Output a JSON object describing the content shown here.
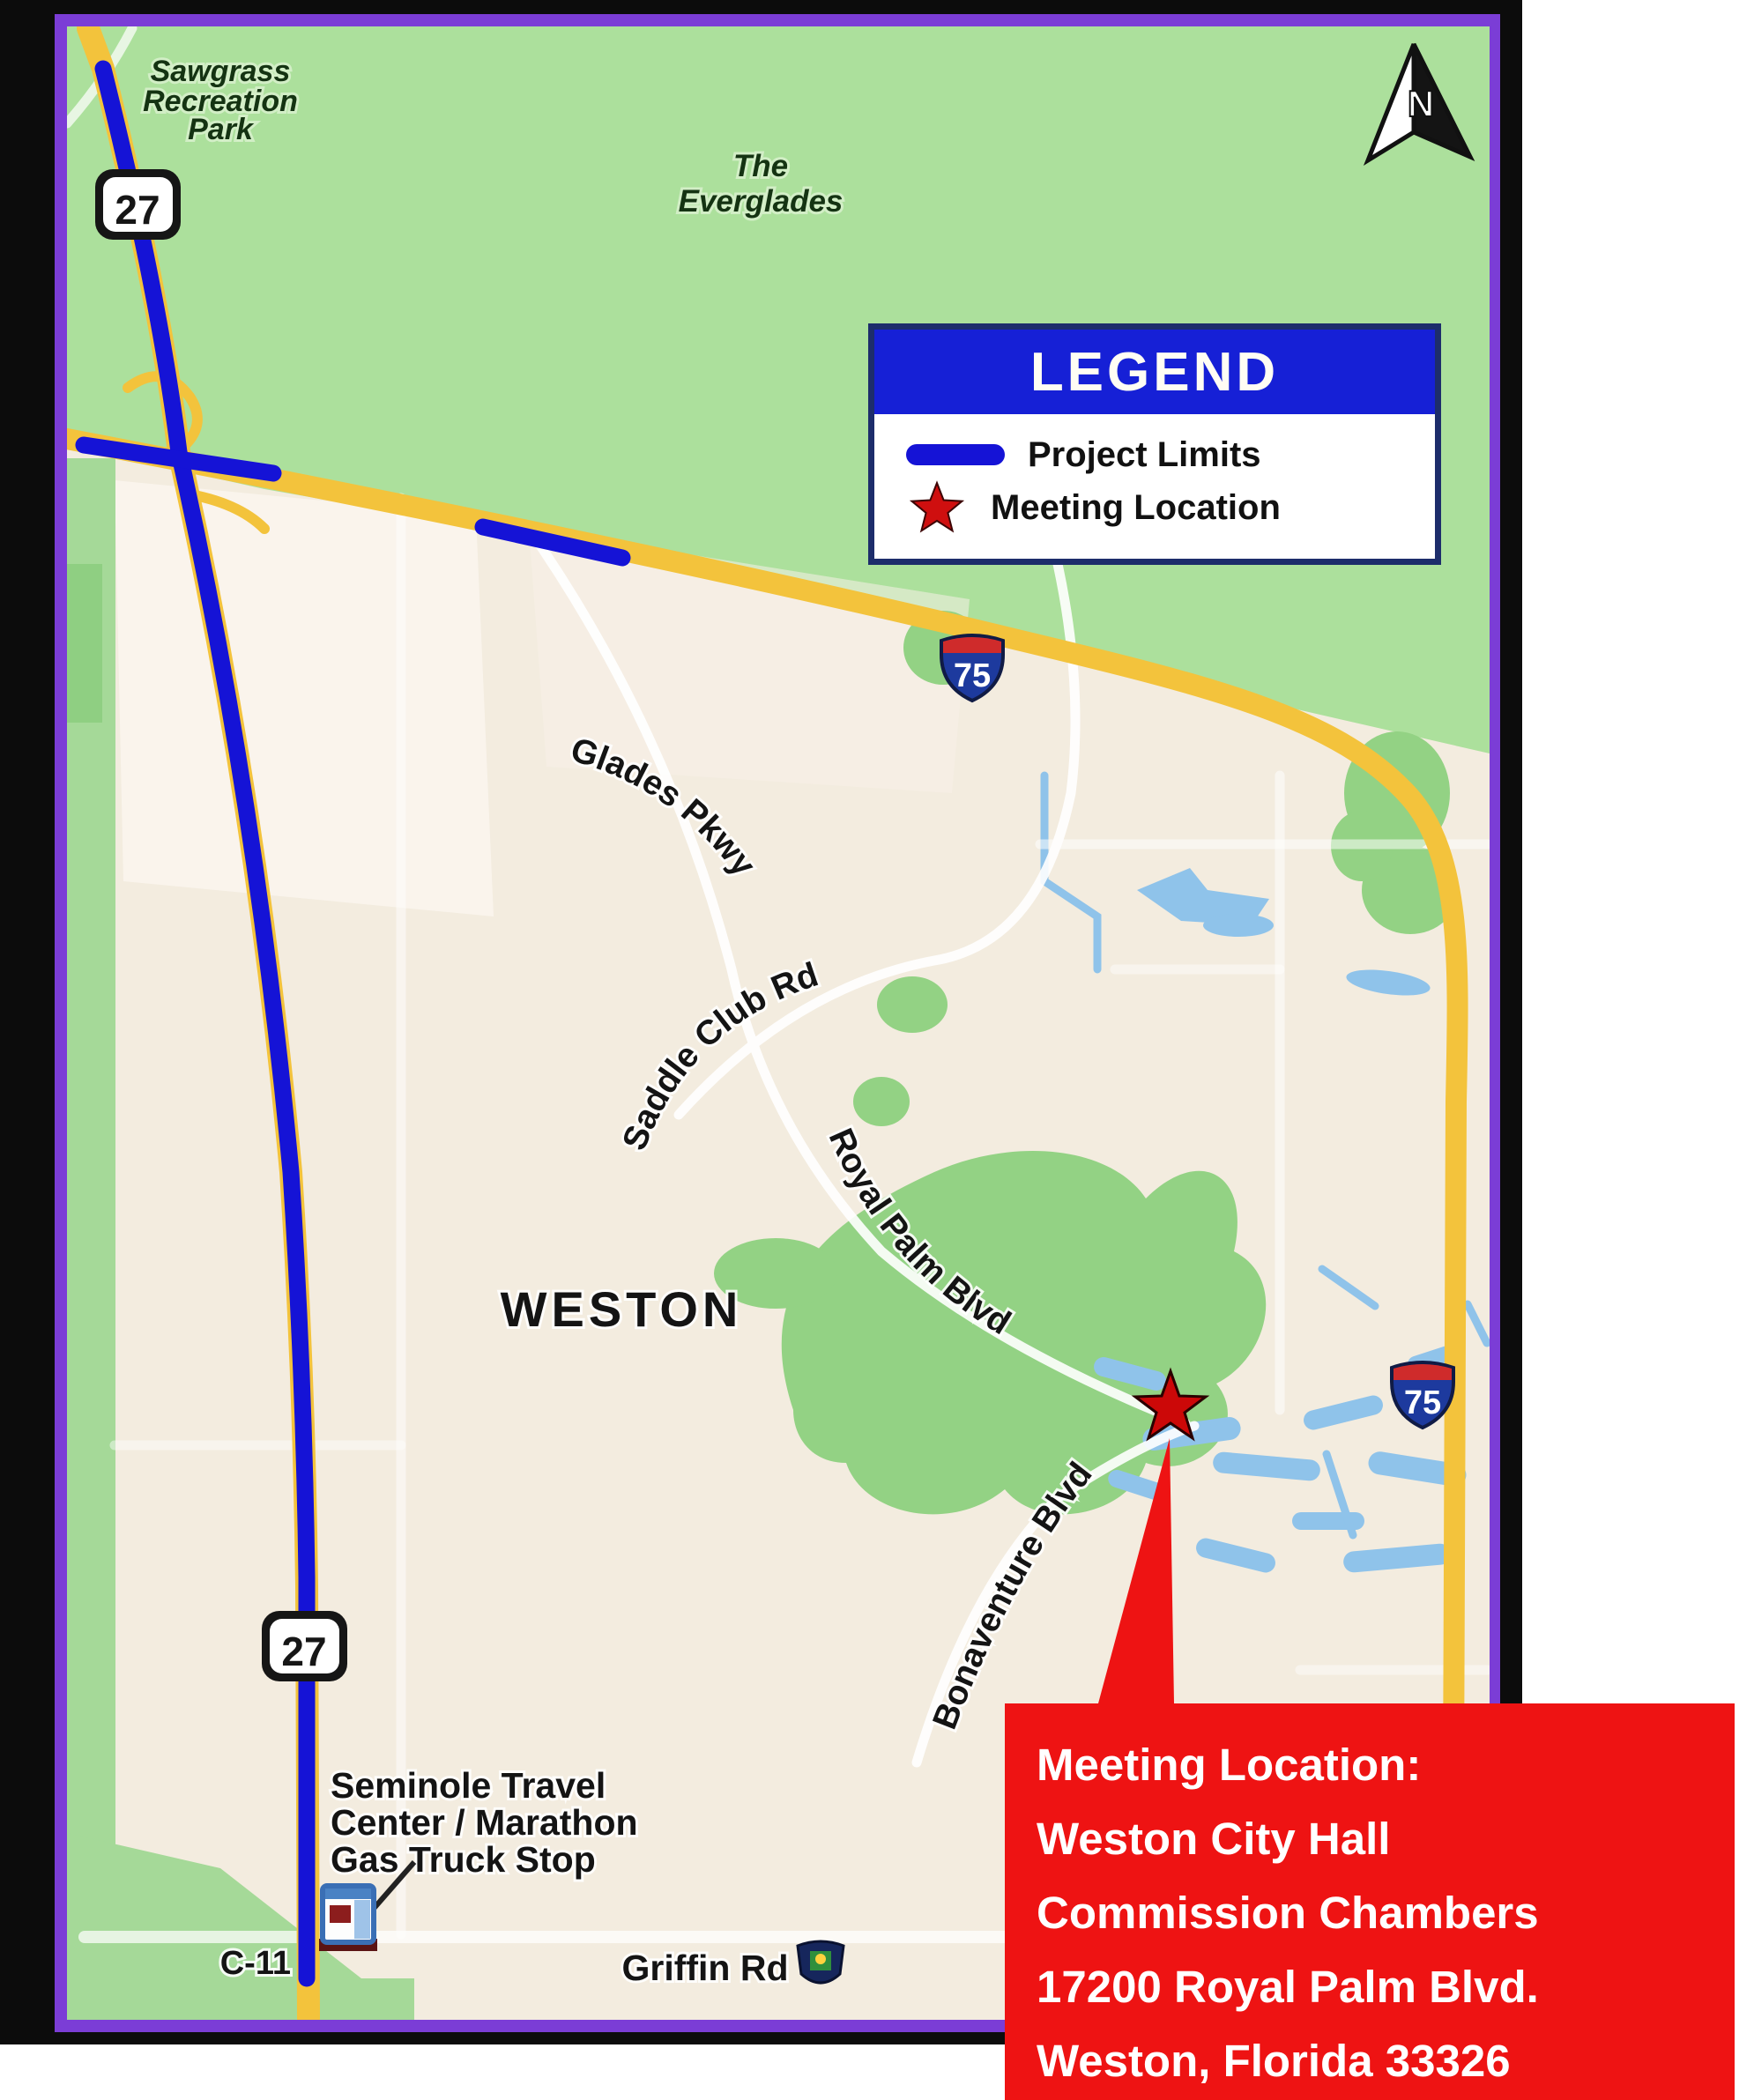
{
  "map": {
    "labels": {
      "park": [
        "Sawgrass",
        "Recreation",
        "Park"
      ],
      "everglades": [
        "The",
        "Everglades"
      ],
      "city": "WESTON",
      "glades_pkwy": "Glades Pkwy",
      "saddle_club": "Saddle Club Rd",
      "royal_palm": "Royal Palm Blvd",
      "bonaventure": "Bonaventure Blvd",
      "seminole": [
        "Seminole Travel",
        "Center / Marathon",
        "Gas Truck Stop"
      ],
      "canal": "C-11",
      "griffin": "Griffin Rd"
    },
    "shields": {
      "us27": "27",
      "i75": "75"
    },
    "north": "N"
  },
  "legend": {
    "title": "LEGEND",
    "items": [
      {
        "label": "Project Limits"
      },
      {
        "label": "Meeting Location"
      }
    ]
  },
  "meeting_box": {
    "lines": [
      "Meeting Location:",
      "Weston City Hall",
      "Commission Chambers",
      "17200 Royal Palm Blvd.",
      "Weston, Florida 33326"
    ]
  },
  "colors": {
    "project_limits_blue": "#1513d6",
    "meeting_red": "#ee1313",
    "legend_header_blue": "#1620d6",
    "frame_purple": "#7b3dd6",
    "everglades_green": "#ace09c",
    "urban_beige": "#f3ecdf",
    "highway_yellow": "#f3c33c",
    "lake_blue": "#8fc3ea"
  }
}
